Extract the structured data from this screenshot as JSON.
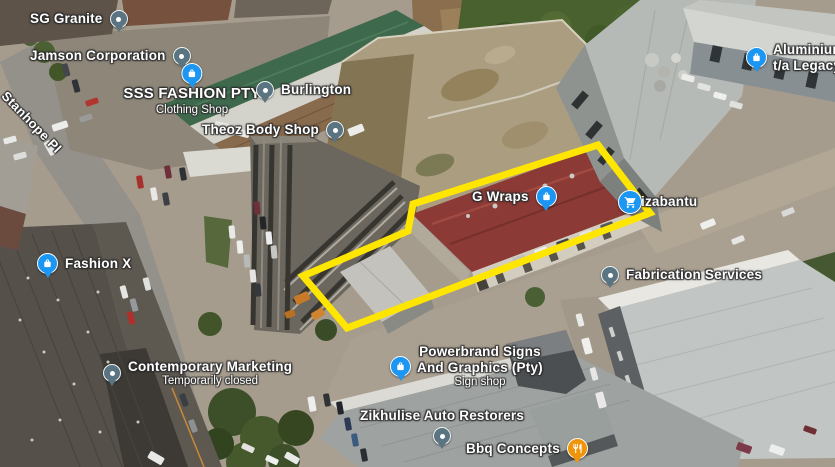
{
  "map": {
    "road_label": "Stanhope Pl",
    "highlight": {
      "color": "#ffe600",
      "points": "413,204 598,145 650,213 347,328 303,276 408,231"
    },
    "pin_colors": {
      "poi": "#5a7482",
      "store": "#1b96f2",
      "restaurant": "#f09409"
    },
    "places": [
      {
        "name": "SG Granite",
        "icon": "poi-pin"
      },
      {
        "name": "Jamson Corporation",
        "icon": "poi-pin"
      },
      {
        "name": "SSS FASHION PTY",
        "subtitle": "Clothing Shop",
        "icon": "shopping-bag-pin"
      },
      {
        "name": "Burlington",
        "icon": "poi-pin"
      },
      {
        "name": "Theoz Body Shop",
        "icon": "poi-pin"
      },
      {
        "name": "Fashion X",
        "icon": "shopping-bag-pin"
      },
      {
        "name": "G Wraps",
        "icon": "shopping-bag-pin"
      },
      {
        "name": "izabantu",
        "icon": "shopping-cart-pin"
      },
      {
        "name": "Fabrication Services",
        "icon": "poi-pin"
      },
      {
        "name": "Contemporary Marketing",
        "subtitle": "Temporarily closed",
        "icon": "poi-pin"
      },
      {
        "name_lines": [
          "Powerbrand Signs",
          "And Graphics (Pty)"
        ],
        "subtitle": "Sign shop",
        "icon": "shopping-bag-pin"
      },
      {
        "name": "Zikhulise Auto Restorers",
        "icon": "poi-pin"
      },
      {
        "name": "Bbq Concepts",
        "icon": "restaurant-pin"
      },
      {
        "name_lines": [
          "Aluminium",
          "t/a Legacy"
        ],
        "icon": "shopping-bag-pin"
      }
    ]
  }
}
